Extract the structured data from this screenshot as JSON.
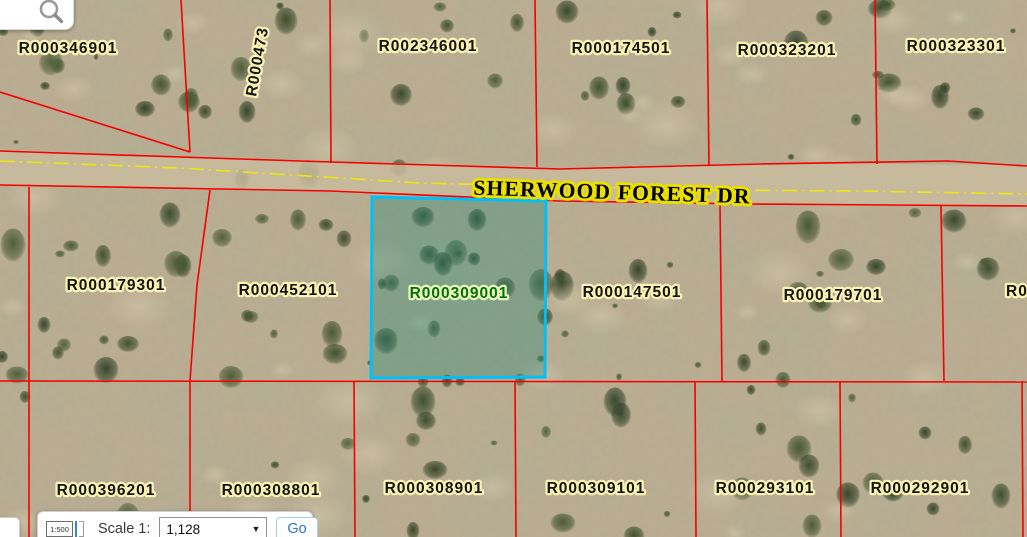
{
  "map": {
    "road_label": "SHERWOOD FOREST DR",
    "parcels": {
      "top": [
        "R000346901",
        "R002346001",
        "R000174501",
        "R000323201",
        "R000323301"
      ],
      "top_vertical_partial": "R000473",
      "middle": [
        "R000179301",
        "R000452101",
        "R000147501",
        "R000179701"
      ],
      "middle_right_partial": "R0",
      "selected": "R000309001",
      "bottom": [
        "R000396201",
        "R000308801",
        "R000308901",
        "R000309101",
        "R000293101",
        "R000292901"
      ]
    },
    "colors": {
      "parcel_line": "#f40000",
      "road_centerline": "#ece41a",
      "selected_outline": "#00c0fc",
      "selected_fill": "rgba(45,140,120,0.38)",
      "label_fill": "#141414",
      "label_halo": "#faf3b4",
      "selected_label_fill": "#0a6e0a",
      "selected_label_halo": "#e6f5bb",
      "road_label_fill": "#000000",
      "road_label_halo": "#e9df00"
    }
  },
  "search": {
    "icon": "magnifier"
  },
  "scale_bar": {
    "icon_text": "1:500",
    "label": "Scale 1:",
    "value": "1,128",
    "dropdown_icon": "▼",
    "go_label": "Go"
  }
}
